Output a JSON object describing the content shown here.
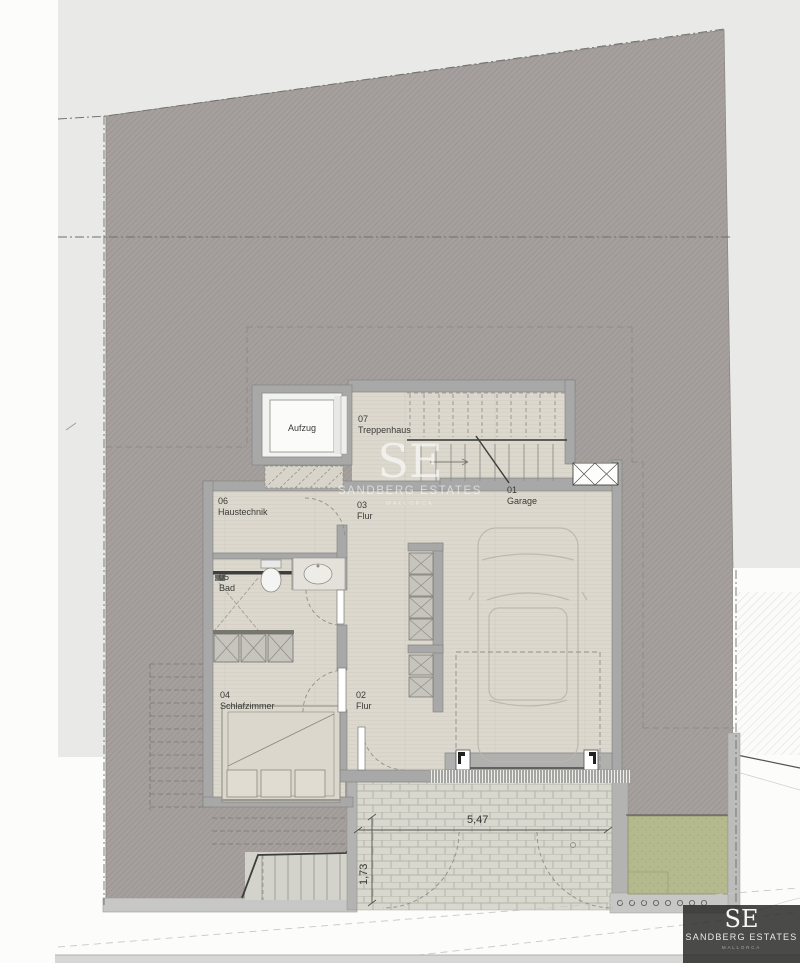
{
  "plan": {
    "elevator_label": "Aufzug",
    "rooms": [
      {
        "number": "07",
        "name": "Treppenhaus"
      },
      {
        "number": "06",
        "name": "Haustechnik"
      },
      {
        "number": "03",
        "name": "Flur"
      },
      {
        "number": "01",
        "name": "Garage"
      },
      {
        "number": "05",
        "name": "Bad"
      },
      {
        "number": "04",
        "name": "Schlafzimmer"
      },
      {
        "number": "02",
        "name": "Flur"
      }
    ],
    "dimensions": {
      "driveway_width": "5,47",
      "gate_width": "1,73"
    }
  },
  "watermark": {
    "monogram": "SE",
    "name": "SANDBERG ESTATES",
    "subtitle": "MALLORCA"
  },
  "logo": {
    "monogram": "SE",
    "name": "SANDBERG ESTATES",
    "subtitle": "MALLORCA"
  },
  "colors": {
    "plot_fill": "#a5a09d",
    "floor_fill": "#dcd8ce",
    "wall_fill": "#a8a8a8",
    "grass_fill": "#b4ba8d",
    "paper_fill": "#e9e9e8",
    "brick_fill": "#d8d8cf"
  }
}
